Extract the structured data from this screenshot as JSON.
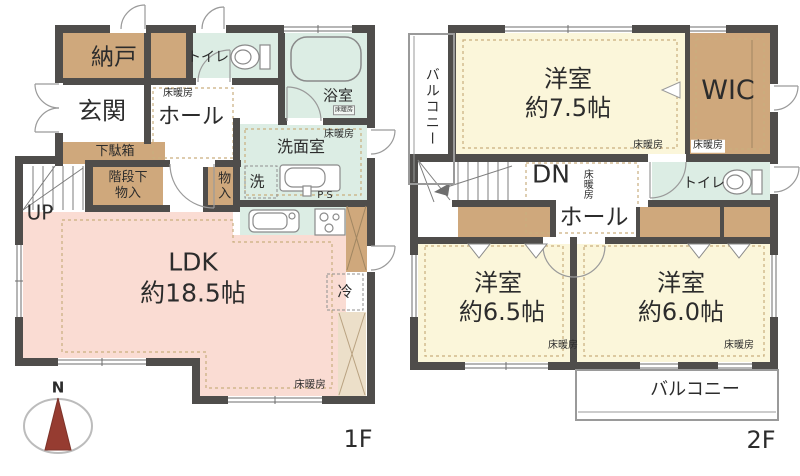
{
  "colors": {
    "wall": "#4f4d4b",
    "ldk_pink": "#fadcd3",
    "room_cream": "#fbf6da",
    "wet_green": "#dcede4",
    "closet_brown": "#cfa87c",
    "pantry_tan": "#ecdfc9",
    "compass_red": "#963c31",
    "dash_tan": "#c9ae7e"
  },
  "floor1": {
    "floor_label": "1F",
    "up_label": "UP",
    "compass_n": "N",
    "rooms": {
      "nando": "納戸",
      "genkan": "玄関",
      "toilet": "トイレ",
      "bath": "浴室",
      "bath_sub": "床暖房",
      "hall_heating": "床暖房",
      "hall": "ホール",
      "getabako": "下駄箱",
      "stair_storage": "階段下\n物入",
      "closet": "物入",
      "washroom": "洗面室",
      "washroom_heating": "床暖房",
      "washer": "洗",
      "ps": "P S",
      "ldk_name": "LDK",
      "ldk_size": "約18.5帖",
      "fridge": "冷",
      "ldk_heating": "床暖房"
    }
  },
  "floor2": {
    "floor_label": "2F",
    "dn_label": "DN",
    "rooms": {
      "balcony_left": "バルコニー",
      "room75_name": "洋室",
      "room75_size": "約7.5帖",
      "room75_heating": "床暖房",
      "wic": "WIC",
      "wic_heating": "床暖房",
      "hall_heating": "床暖房",
      "hall": "ホール",
      "toilet": "トイレ",
      "room65_name": "洋室",
      "room65_size": "約6.5帖",
      "room65_heating": "床暖房",
      "room60_name": "洋室",
      "room60_size": "約6.0帖",
      "room60_heating": "床暖房",
      "balcony_bottom": "バルコニー"
    }
  }
}
